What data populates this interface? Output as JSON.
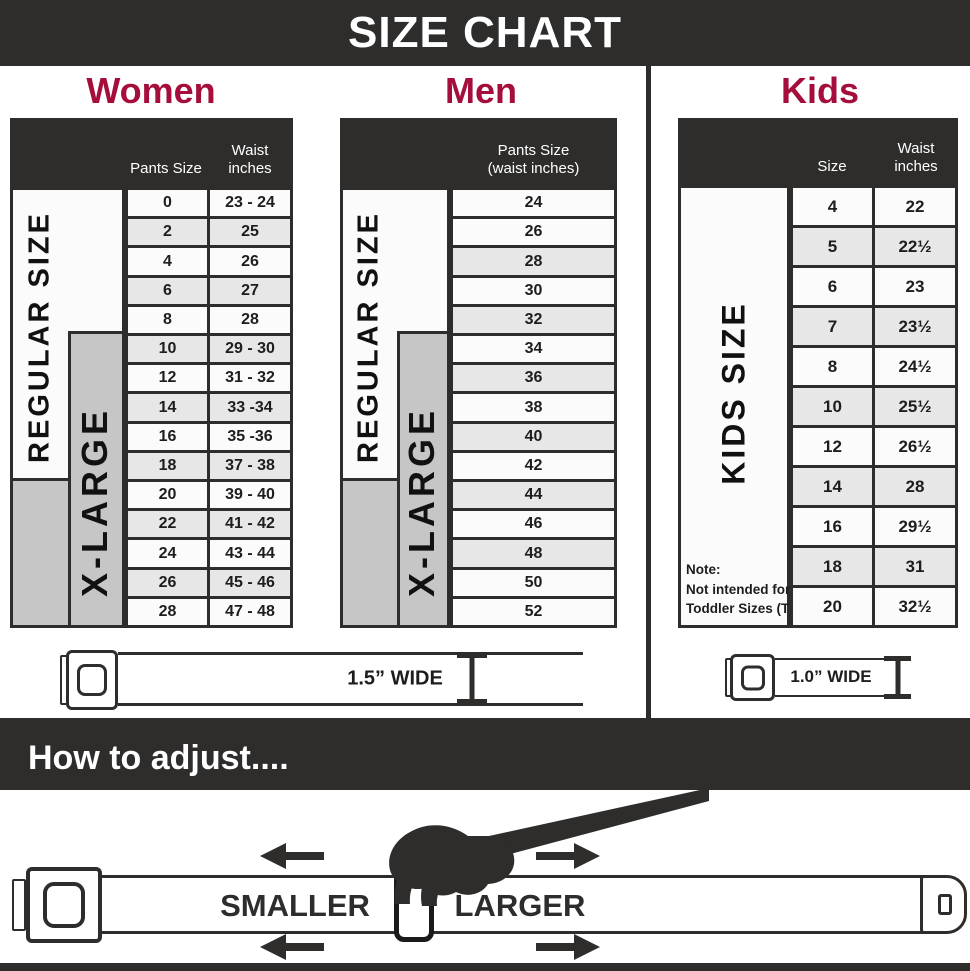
{
  "title": "SIZE CHART",
  "sections": {
    "women": {
      "heading": "Women",
      "col1_header": "Pants Size",
      "col2_header_line1": "Waist",
      "col2_header_line2": "inches",
      "regular_label": "REGULAR SIZE",
      "xlarge_label": "X-LARGE",
      "rows": [
        {
          "size": "0",
          "waist": "23 - 24"
        },
        {
          "size": "2",
          "waist": "25"
        },
        {
          "size": "4",
          "waist": "26"
        },
        {
          "size": "6",
          "waist": "27"
        },
        {
          "size": "8",
          "waist": "28"
        },
        {
          "size": "10",
          "waist": "29 - 30"
        },
        {
          "size": "12",
          "waist": "31 - 32"
        },
        {
          "size": "14",
          "waist": "33 -34"
        },
        {
          "size": "16",
          "waist": "35 -36"
        },
        {
          "size": "18",
          "waist": "37 - 38"
        },
        {
          "size": "20",
          "waist": "39 - 40"
        },
        {
          "size": "22",
          "waist": "41 - 42"
        },
        {
          "size": "24",
          "waist": "43 - 44"
        },
        {
          "size": "26",
          "waist": "45 - 46"
        },
        {
          "size": "28",
          "waist": "47 - 48"
        }
      ]
    },
    "men": {
      "heading": "Men",
      "col_header_line1": "Pants Size",
      "col_header_line2": "(waist inches)",
      "regular_label": "REGULAR SIZE",
      "xlarge_label": "X-LARGE",
      "rows": [
        "24",
        "26",
        "28",
        "30",
        "32",
        "34",
        "36",
        "38",
        "40",
        "42",
        "44",
        "46",
        "48",
        "50",
        "52"
      ]
    },
    "kids": {
      "heading": "Kids",
      "col1_header": "Size",
      "col2_header_line1": "Waist",
      "col2_header_line2": "inches",
      "side_label": "KIDS SIZE",
      "note_lines": [
        "Note:",
        "Not intended for",
        "Toddler Sizes (T)"
      ],
      "rows": [
        {
          "size": "4",
          "waist": "22"
        },
        {
          "size": "5",
          "waist": "22½"
        },
        {
          "size": "6",
          "waist": "23"
        },
        {
          "size": "7",
          "waist": "23½"
        },
        {
          "size": "8",
          "waist": "24½"
        },
        {
          "size": "10",
          "waist": "25½"
        },
        {
          "size": "12",
          "waist": "26½"
        },
        {
          "size": "14",
          "waist": "28"
        },
        {
          "size": "16",
          "waist": "29½"
        },
        {
          "size": "18",
          "waist": "31"
        },
        {
          "size": "20",
          "waist": "32½"
        }
      ]
    }
  },
  "belts": {
    "adult_width_label": "1.5” WIDE",
    "kids_width_label": "1.0” WIDE"
  },
  "how_to_adjust": {
    "title": "How to adjust....",
    "smaller_label": "SMALLER",
    "larger_label": "LARGER"
  },
  "colors": {
    "accent": "#a50d3b",
    "dark": "#2e2d2c",
    "row_alt": "#e7e7e7",
    "xlarge_gray": "#c6c6c6"
  },
  "chart_data": [
    {
      "type": "table",
      "title": "Women belt sizes",
      "columns": [
        "Pants Size",
        "Waist inches"
      ],
      "rows": [
        [
          "0",
          "23 - 24"
        ],
        [
          "2",
          "25"
        ],
        [
          "4",
          "26"
        ],
        [
          "6",
          "27"
        ],
        [
          "8",
          "28"
        ],
        [
          "10",
          "29 - 30"
        ],
        [
          "12",
          "31 - 32"
        ],
        [
          "14",
          "33 -34"
        ],
        [
          "16",
          "35 -36"
        ],
        [
          "18",
          "37 - 38"
        ],
        [
          "20",
          "39 - 40"
        ],
        [
          "22",
          "41 - 42"
        ],
        [
          "24",
          "43 - 44"
        ],
        [
          "26",
          "45 - 46"
        ],
        [
          "28",
          "47 - 48"
        ]
      ],
      "annotations": [
        "REGULAR SIZE (sizes 0-18)",
        "X-LARGE (sizes 10-28)",
        "1.5\" WIDE"
      ]
    },
    {
      "type": "table",
      "title": "Men belt sizes",
      "columns": [
        "Pants Size (waist inches)"
      ],
      "rows": [
        [
          "24"
        ],
        [
          "26"
        ],
        [
          "28"
        ],
        [
          "30"
        ],
        [
          "32"
        ],
        [
          "34"
        ],
        [
          "36"
        ],
        [
          "38"
        ],
        [
          "40"
        ],
        [
          "42"
        ],
        [
          "44"
        ],
        [
          "46"
        ],
        [
          "48"
        ],
        [
          "50"
        ],
        [
          "52"
        ]
      ],
      "annotations": [
        "REGULAR SIZE (24-40)",
        "X-LARGE (34-52)",
        "1.5\" WIDE"
      ]
    },
    {
      "type": "table",
      "title": "Kids belt sizes",
      "columns": [
        "Size",
        "Waist inches"
      ],
      "rows": [
        [
          "4",
          "22"
        ],
        [
          "5",
          "22½"
        ],
        [
          "6",
          "23"
        ],
        [
          "7",
          "23½"
        ],
        [
          "8",
          "24½"
        ],
        [
          "10",
          "25½"
        ],
        [
          "12",
          "26½"
        ],
        [
          "14",
          "28"
        ],
        [
          "16",
          "29½"
        ],
        [
          "18",
          "31"
        ],
        [
          "20",
          "32½"
        ]
      ],
      "annotations": [
        "KIDS SIZE",
        "Note: Not intended for Toddler Sizes (T)",
        "1.0\" WIDE"
      ]
    }
  ]
}
